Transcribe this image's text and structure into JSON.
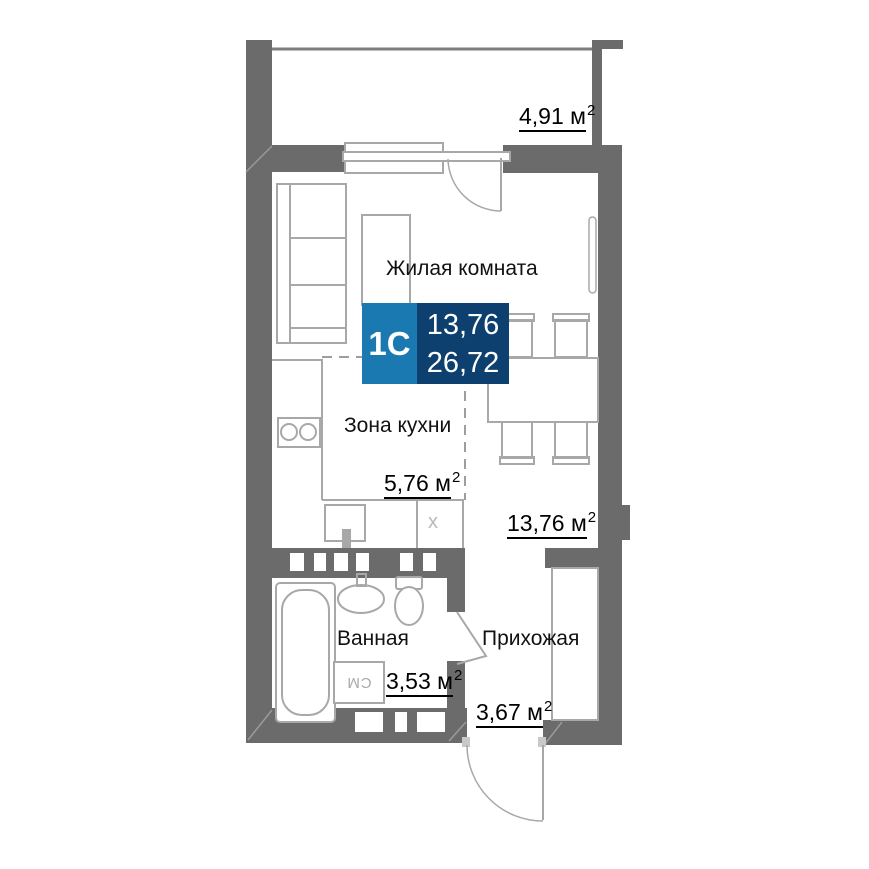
{
  "badge": {
    "code": "1С",
    "living_area": "13,76",
    "total_area": "26,72"
  },
  "labels": {
    "living_name": "Жилая комната",
    "kitchen_name": "Зона кухни",
    "bathroom_name": "Ванная",
    "hallway_name": "Прихожая",
    "balcony_area": "4,91",
    "living_area": "13,76",
    "kitchen_area": "5,76",
    "bathroom_area": "3,53",
    "hallway_area": "3,67",
    "unit": "м",
    "sup": "2"
  },
  "symbols": {
    "washing_machine": "СМ",
    "x_mark": "х"
  },
  "colors": {
    "wall": "#6b6b6b",
    "furniture_line": "#a8a8a8",
    "dashed_zone_line": "#9e9e9e",
    "badge_light_blue": "#1b79b1",
    "badge_dark_blue": "#0d406f",
    "text": "#000000",
    "background": "#ffffff"
  }
}
